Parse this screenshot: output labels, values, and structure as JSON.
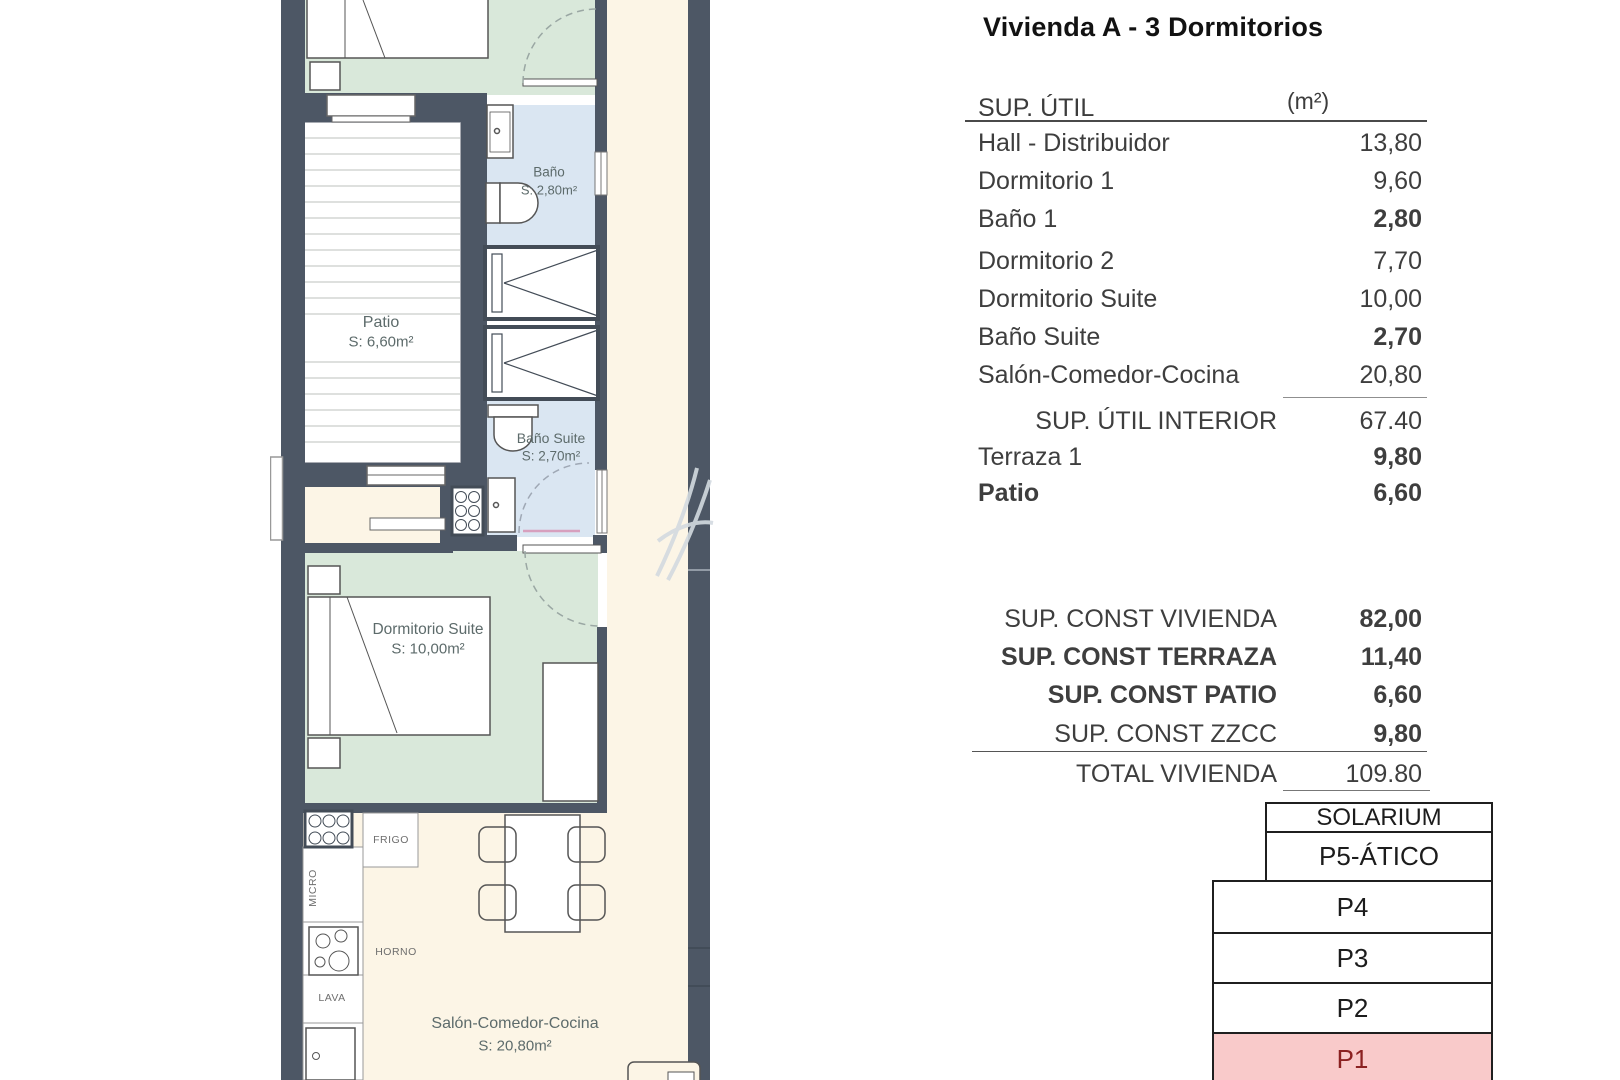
{
  "title": "Vivienda A - 3 Dormitorios",
  "table": {
    "header": {
      "label": "SUP. ÚTIL",
      "unit": "(m²)"
    },
    "rows": [
      {
        "label": "Hall - Distribuidor",
        "value": "13,80"
      },
      {
        "label": "Dormitorio 1",
        "value": "9,60"
      },
      {
        "label": "Baño 1",
        "value": "2,80"
      },
      {
        "label": "Dormitorio 2",
        "value": "7,70"
      },
      {
        "label": "Dormitorio Suite",
        "value": "10,00"
      },
      {
        "label": "Baño Suite",
        "value": "2,70"
      },
      {
        "label": "Salón-Comedor-Cocina",
        "value": "20,80"
      },
      {
        "label": "SUP. ÚTIL INTERIOR",
        "value": "67.40"
      },
      {
        "label": "Terraza 1",
        "value": "9,80"
      },
      {
        "label": "Patio",
        "value": "6,60"
      }
    ],
    "summary": [
      {
        "label": "SUP. CONST VIVIENDA",
        "value": "82,00"
      },
      {
        "label": "SUP. CONST TERRAZA",
        "value": "11,40"
      },
      {
        "label": "SUP. CONST PATIO",
        "value": "6,60"
      },
      {
        "label": "SUP. CONST ZZCC",
        "value": "9,80"
      }
    ],
    "total": {
      "label": "TOTAL VIVIENDA",
      "value": "109.80"
    }
  },
  "levels": [
    "SOLARIUM",
    "P5-ÁTICO",
    "P4",
    "P3",
    "P2",
    "P1"
  ],
  "highlighted_level": "P1",
  "plan": {
    "rooms": {
      "patio": {
        "name": "Patio",
        "area": "S: 6,60m²"
      },
      "bano": {
        "name": "Baño",
        "area": "S: 2,80m²"
      },
      "bano_suite": {
        "name": "Baño Suite",
        "area": "S: 2,70m²"
      },
      "dormitorio_suite": {
        "name": "Dormitorio Suite",
        "area": "S: 10,00m²"
      },
      "salon": {
        "name": "Salón-Comedor-Cocina",
        "area": "S: 20,80m²"
      }
    },
    "appliances": {
      "frigo": "FRIGO",
      "micro": "MICRO",
      "horno": "HORNO",
      "lava": "LAVA"
    }
  },
  "colors": {
    "wall": "#4d5765",
    "room_green": "#d9e8da",
    "room_blue": "#dae6f2",
    "floor_cream": "#fcf5e6",
    "highlight_pink": "#f9caca",
    "highlight_red": "#8b2121"
  }
}
